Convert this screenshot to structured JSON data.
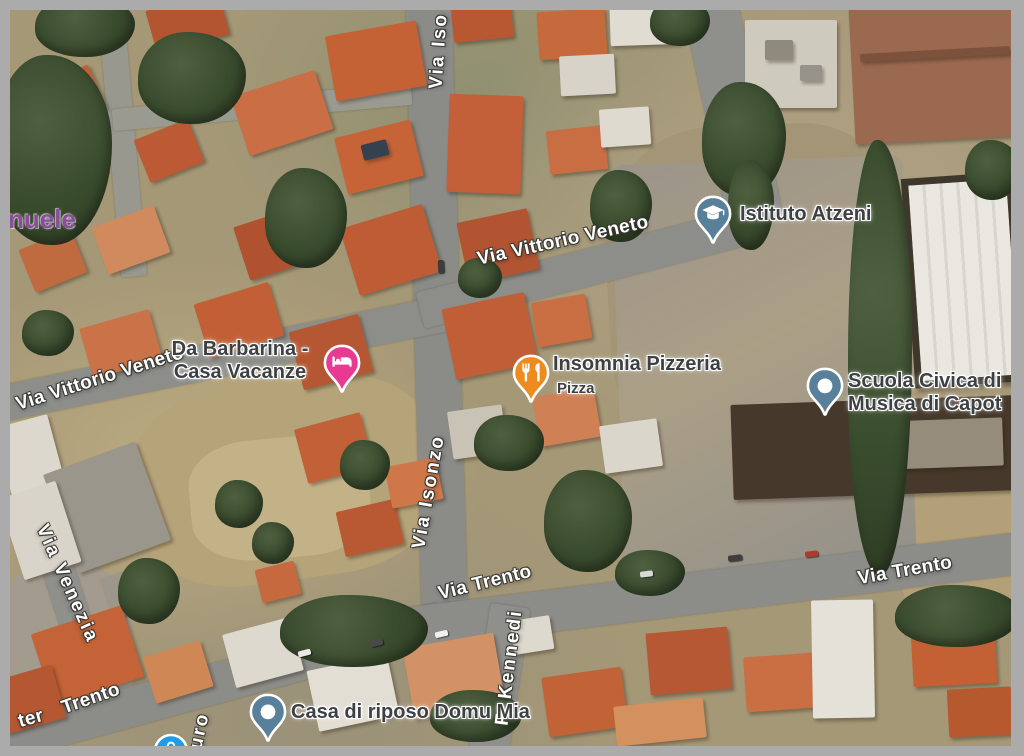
{
  "map": {
    "frame_color": "#ababab",
    "area_label_partial": "nuele",
    "streets": [
      {
        "id": "isonzo-top",
        "text": "Via Iso"
      },
      {
        "id": "isonzo-mid",
        "text": "Via Isonzo"
      },
      {
        "id": "vittorio-veneto-left",
        "text": "Via Vittorio Veneto"
      },
      {
        "id": "vittorio-veneto-top",
        "text": "Via Vittorio Veneto"
      },
      {
        "id": "venezia",
        "text": "Via Venezia"
      },
      {
        "id": "trento-left-partial",
        "text": "ter"
      },
      {
        "id": "trento-left",
        "text": "Trento"
      },
      {
        "id": "trento-mid",
        "text": "Via Trento"
      },
      {
        "id": "trento-right",
        "text": "Via Trento"
      },
      {
        "id": "kennedi",
        "text": "F. Kennedi"
      },
      {
        "id": "partial-uro",
        "text": "uro"
      }
    ],
    "pois": [
      {
        "name": "Istituto Atzeni",
        "type": "school",
        "pin_color": "#58809a",
        "icon": "graduation-cap"
      },
      {
        "name": "Insomnia Pizzeria",
        "subtitle": "Pizza",
        "type": "restaurant",
        "pin_color": "#ee8b1f",
        "icon": "fork-knife"
      },
      {
        "line1": "Da Barbarina -",
        "line2": "Casa Vacanze",
        "type": "lodging",
        "pin_color": "#e93a92",
        "icon": "bed"
      },
      {
        "line1": "Scuola Civica di",
        "line2": "Musica di Capot",
        "type": "generic",
        "pin_color": "#58809a",
        "icon": "dot"
      },
      {
        "name": "Casa di riposo Domu Mia",
        "type": "generic",
        "pin_color": "#58809a",
        "icon": "dot"
      }
    ],
    "partial_blue_pin_color": "#1d9de9"
  }
}
